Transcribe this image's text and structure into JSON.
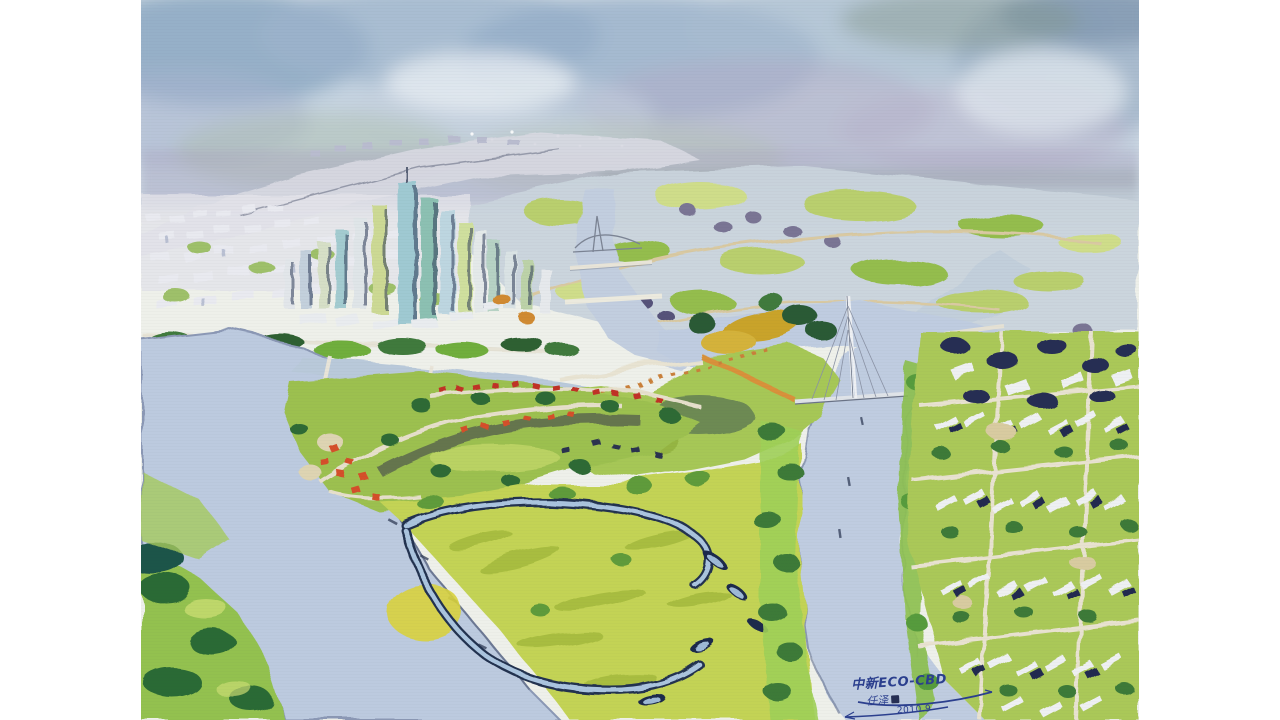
{
  "artwork": {
    "inscription": {
      "title": "中新ECO-CBD",
      "signature": "任泽",
      "date": "2010.9"
    },
    "palette": {
      "sky_blue": "#8fa8c4",
      "haze_lavender": "#b3aec9",
      "river_blue": "#bccadf",
      "meadow_green": "#c3d355",
      "leaf_green": "#6fae3e",
      "deep_green": "#2c6a34",
      "navy_shadow": "#24314f",
      "autumn_orange": "#d8913a",
      "roof_red": "#c03028",
      "tower_teal": "#8cc0b2",
      "paper_white": "#f2f4ef",
      "ink_blue": "#2b3f8e",
      "seal_navy": "#272f54"
    }
  }
}
